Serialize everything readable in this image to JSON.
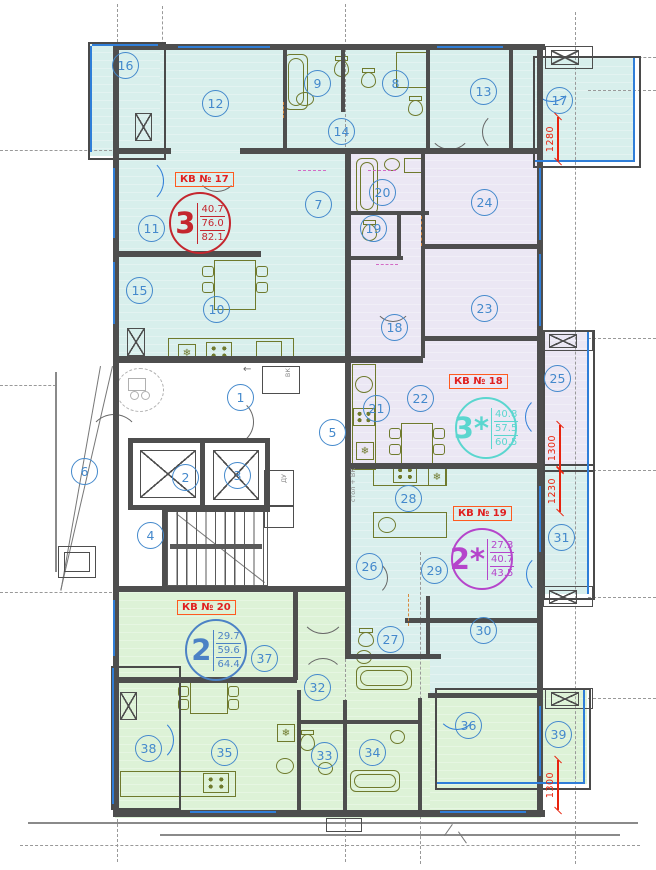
{
  "apartments": [
    {
      "id": "17",
      "label": "КВ № 17",
      "type": "3",
      "areas": [
        "40.7",
        "76.0",
        "82.1"
      ],
      "color": "#c4262e"
    },
    {
      "id": "18",
      "label": "КВ № 18",
      "type": "3*",
      "areas": [
        "40.8",
        "57.5",
        "60.5"
      ],
      "color": "#5bd6cf"
    },
    {
      "id": "19",
      "label": "КВ № 19",
      "type": "2*",
      "areas": [
        "27.3",
        "40.7",
        "43.5"
      ],
      "color": "#b545cb"
    },
    {
      "id": "20",
      "label": "КВ № 20",
      "type": "2",
      "areas": [
        "29.7",
        "59.6",
        "64.4"
      ],
      "color": "#4c82c5"
    }
  ],
  "rooms": [
    {
      "n": "1",
      "x": 240,
      "y": 397
    },
    {
      "n": "2",
      "x": 185,
      "y": 477
    },
    {
      "n": "3",
      "x": 237,
      "y": 475
    },
    {
      "n": "4",
      "x": 150,
      "y": 535
    },
    {
      "n": "5",
      "x": 332,
      "y": 432
    },
    {
      "n": "6",
      "x": 84,
      "y": 471
    },
    {
      "n": "7",
      "x": 318,
      "y": 204
    },
    {
      "n": "8",
      "x": 395,
      "y": 83
    },
    {
      "n": "9",
      "x": 317,
      "y": 83
    },
    {
      "n": "10",
      "x": 216,
      "y": 309
    },
    {
      "n": "11",
      "x": 151,
      "y": 228
    },
    {
      "n": "12",
      "x": 215,
      "y": 103
    },
    {
      "n": "13",
      "x": 483,
      "y": 91
    },
    {
      "n": "14",
      "x": 341,
      "y": 131
    },
    {
      "n": "15",
      "x": 139,
      "y": 290
    },
    {
      "n": "16",
      "x": 125,
      "y": 65
    },
    {
      "n": "17",
      "x": 559,
      "y": 100
    },
    {
      "n": "18",
      "x": 394,
      "y": 327
    },
    {
      "n": "19",
      "x": 373,
      "y": 228
    },
    {
      "n": "20",
      "x": 382,
      "y": 192
    },
    {
      "n": "21",
      "x": 376,
      "y": 408
    },
    {
      "n": "22",
      "x": 420,
      "y": 398
    },
    {
      "n": "23",
      "x": 484,
      "y": 308
    },
    {
      "n": "24",
      "x": 484,
      "y": 202
    },
    {
      "n": "25",
      "x": 557,
      "y": 378
    },
    {
      "n": "26",
      "x": 369,
      "y": 566
    },
    {
      "n": "27",
      "x": 390,
      "y": 639
    },
    {
      "n": "28",
      "x": 408,
      "y": 498
    },
    {
      "n": "29",
      "x": 434,
      "y": 570
    },
    {
      "n": "30",
      "x": 483,
      "y": 630
    },
    {
      "n": "31",
      "x": 561,
      "y": 537
    },
    {
      "n": "32",
      "x": 317,
      "y": 687
    },
    {
      "n": "33",
      "x": 324,
      "y": 755
    },
    {
      "n": "34",
      "x": 372,
      "y": 752
    },
    {
      "n": "35",
      "x": 224,
      "y": 752
    },
    {
      "n": "36",
      "x": 468,
      "y": 725
    },
    {
      "n": "37",
      "x": 264,
      "y": 658
    },
    {
      "n": "38",
      "x": 148,
      "y": 748
    },
    {
      "n": "39",
      "x": 558,
      "y": 734
    }
  ],
  "dimensions": [
    {
      "value": "1280",
      "x": 558,
      "y": 117,
      "len": 44
    },
    {
      "value": "1300",
      "x": 560,
      "y": 425,
      "len": 45
    },
    {
      "value": "1230",
      "x": 560,
      "y": 470,
      "len": 42
    },
    {
      "value": "1300",
      "x": 558,
      "y": 760,
      "len": 50
    }
  ],
  "annotations": {
    "shaft_top": "ВК",
    "shaft_mid": "ДУ",
    "kitchen_note": "стол + ВК"
  },
  "icons": {
    "fridge": "❄",
    "entry-arrow": "←"
  },
  "colors": {
    "wall": "#4e4e4e",
    "fixture": "#6f7a2d",
    "room_circle": "#4489cc",
    "dimension": "#e8230e",
    "label_border": "#ff5a1f",
    "label_text": "#e02020",
    "glazing": "#2f7ed8",
    "axis": "#999999",
    "apt17_fill": "#d8efec",
    "apt18_fill": "#ebe7f4",
    "apt19_fill": "#d9efed",
    "apt20_fill": "#ddf2d7"
  }
}
